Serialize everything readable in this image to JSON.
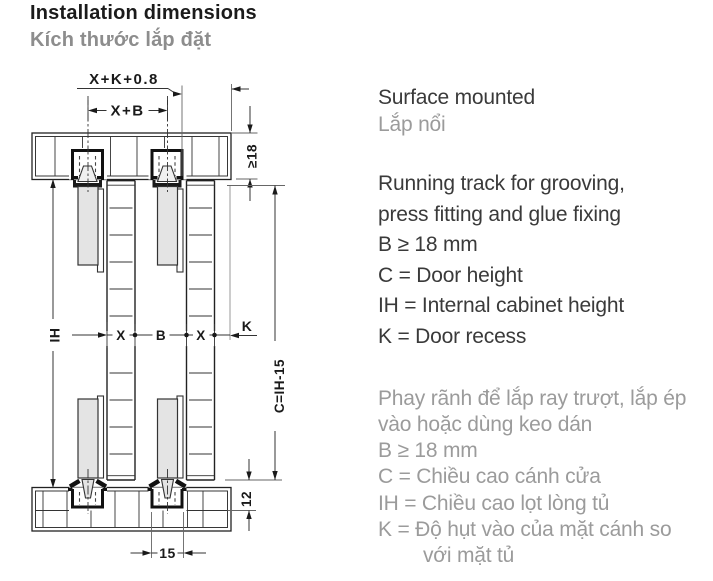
{
  "header": {
    "title_en": "Installation dimensions",
    "title_vi": "Kích thước lắp đặt"
  },
  "legend": {
    "heading_en": "Surface mounted",
    "heading_vi": "Lắp nổi",
    "en_lines": [
      "Running track for grooving,",
      "press fitting and glue fixing",
      "B ≥ 18 mm",
      "C = Door height",
      "IH = Internal cabinet height",
      "K = Door recess"
    ],
    "vi_lines": [
      "Phay rãnh để lắp ray trượt, lắp ép",
      "vào hoặc dùng keo dán",
      "B ≥ 18 mm",
      "C = Chiều cao cánh cửa",
      "IH = Chiều cao lọt lòng tủ",
      "K = Độ hụt vào của mặt cánh so",
      "với mặt tủ"
    ]
  },
  "diagram": {
    "dims": {
      "top_outer": "X+K+0.8",
      "top_inner": "X+B",
      "board_thickness": "≥18",
      "internal_height": "IH",
      "door1_thickness": "X",
      "door_gap": "B",
      "door2_thickness": "X",
      "door_recess": "K",
      "door_height": "C=IH-15",
      "bottom_engagement": "12",
      "bottom_track_width": "15"
    }
  },
  "colors": {
    "text_dark": "#3a3a3a",
    "text_gray": "#9b9b9b",
    "title_gray": "#8d8d8d",
    "drawing_line": "#222222",
    "profile_fill": "#e4e4e4"
  }
}
